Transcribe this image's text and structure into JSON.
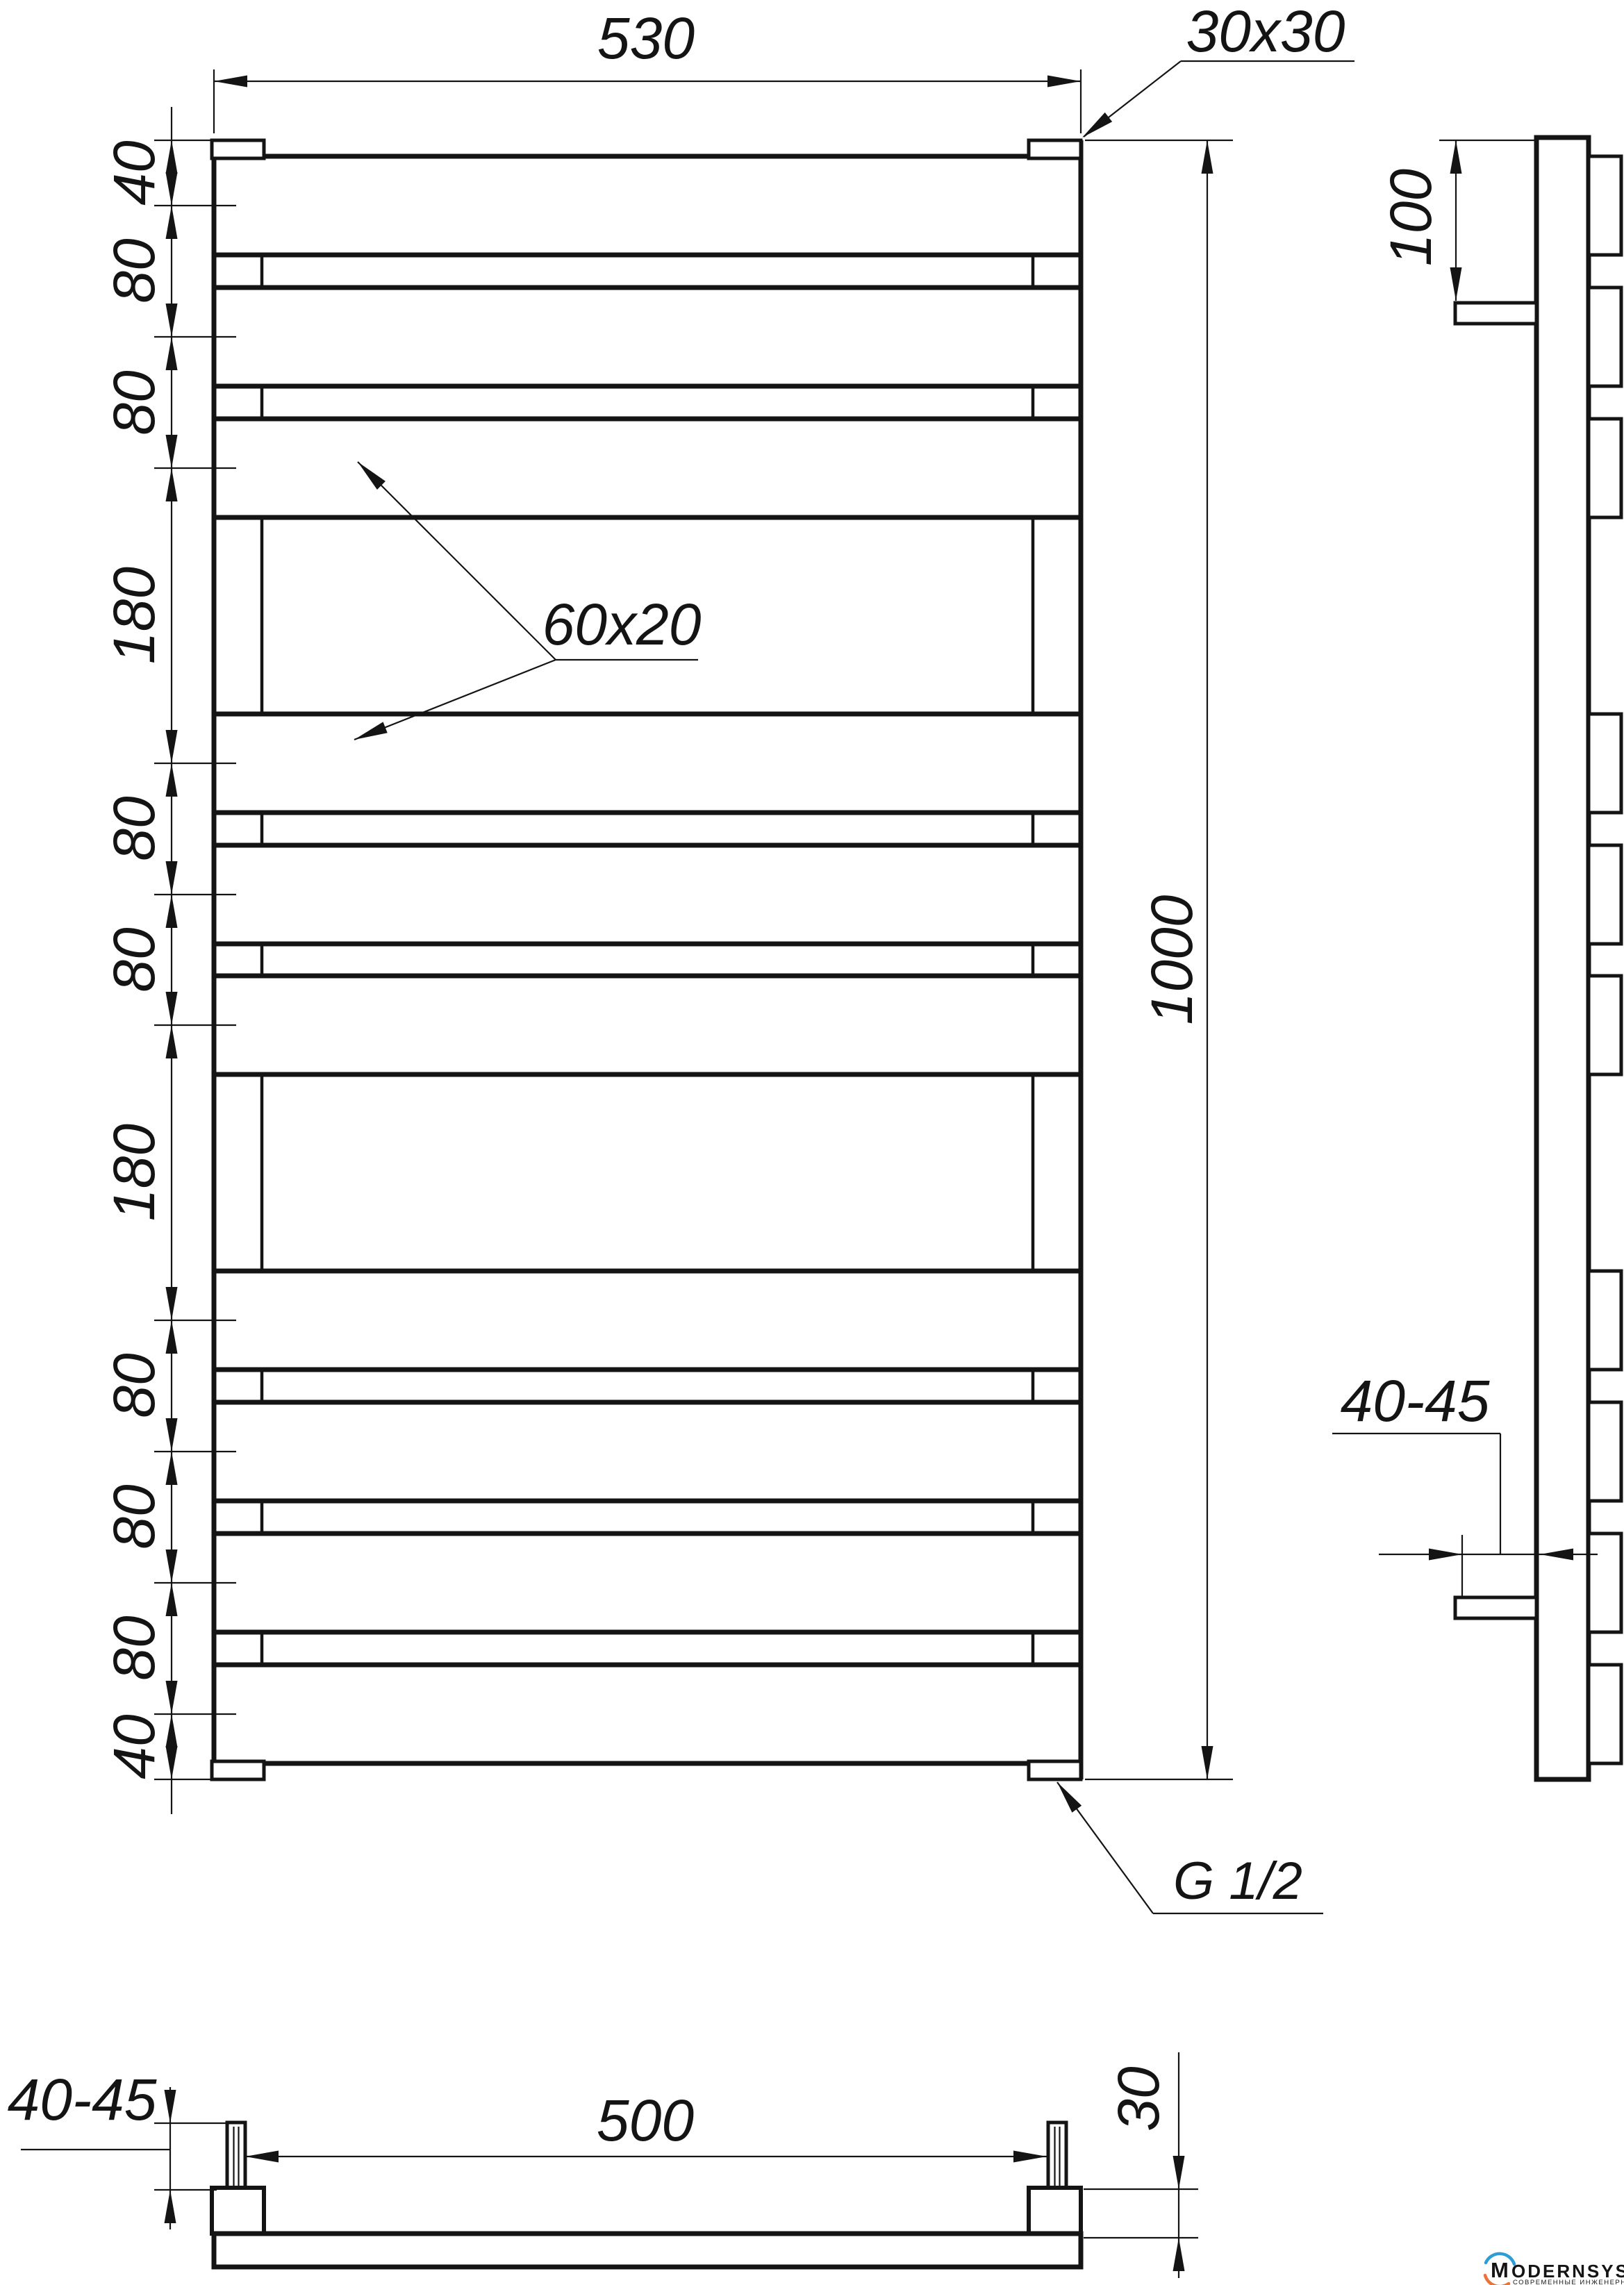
{
  "front_view": {
    "width_label": "530",
    "collector_profile_label": "30x30",
    "rung_profile_label": "60x20",
    "height_label": "1000",
    "thread_label": "G 1/2",
    "spacing_chain": [
      "40",
      "80",
      "80",
      "180",
      "80",
      "80",
      "180",
      "80",
      "80",
      "80",
      "40"
    ]
  },
  "side_view": {
    "bracket_offset_label": "100",
    "wall_clearance_label": "40-45"
  },
  "bottom_view": {
    "wall_clearance_label": "40-45",
    "bracket_spacing_label": "500",
    "collector_depth_label": "30"
  },
  "logo": {
    "wordmark_initial": "M",
    "wordmark_rest": "ODERNSYS",
    "tagline": "СОВРЕМЕННЫЕ ИНЖЕНЕРНЫЕ СИСТЕМЫ",
    "arc_top_color": "#2d9dd6",
    "arc_bottom_color": "#e8743a",
    "wordmark_color": "#3c3c3e",
    "tagline_color": "#8f9093"
  }
}
